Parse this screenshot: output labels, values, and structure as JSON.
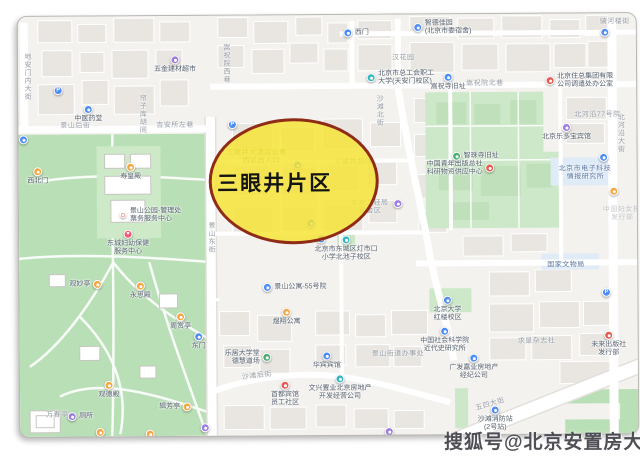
{
  "region_annotation": {
    "label": "三眼井片区",
    "ellipse_fill": "#F6E434",
    "ellipse_border": "#8F2B17"
  },
  "watermark": {
    "text": "搜狐号@北京安置房大全"
  },
  "colors": {
    "map_bg": "#f4f2ef",
    "building": "#e9e6e2",
    "park_green": "#b9dfb6",
    "institution_green": "#cde8c8",
    "poi_box_blue": "#e0ebf8",
    "road": "#ffffff",
    "pin_blue": "#4e8df5",
    "pin_teal": "#35b8c2",
    "pin_purple": "#9d7ce0",
    "pin_orange": "#f5a742",
    "pin_red": "#e8594f",
    "pin_green": "#4caf6e",
    "pin_heart": "#ef5b77"
  },
  "streets": [
    {
      "id": "st-dianmennei",
      "text": "地安门内大街",
      "x": 4,
      "y": 36,
      "vertical": true
    },
    {
      "id": "st-jingshanhou",
      "text": "景山后街",
      "x": 42,
      "y": 104,
      "vertical": false
    },
    {
      "id": "st-jiansuozuo",
      "text": "吉安所左巷",
      "x": 138,
      "y": 104,
      "vertical": false
    },
    {
      "id": "st-lianziku",
      "text": "帘子库胡同",
      "x": 119,
      "y": 78,
      "vertical": true
    },
    {
      "id": "st-songzhuxixiang",
      "text": "嵩祝院西巷",
      "x": 203,
      "y": 28,
      "vertical": true
    },
    {
      "id": "st-shatanbei",
      "text": "沙滩北街",
      "x": 356,
      "y": 80,
      "vertical": true
    },
    {
      "id": "st-songzhubeixiang",
      "text": "嵩祝院北巷",
      "x": 448,
      "y": 64,
      "vertical": false
    },
    {
      "id": "st-beiheyan",
      "text": "北河沿大街",
      "x": 597,
      "y": 100,
      "vertical": true
    },
    {
      "id": "st-jingshandong",
      "text": "景山东街",
      "x": 187,
      "y": 206,
      "vertical": true
    },
    {
      "id": "st-shatanhou",
      "text": "沙滩后街",
      "x": 222,
      "y": 355,
      "vertical": false,
      "angle": -6
    },
    {
      "id": "st-wusidajie",
      "text": "五四大街",
      "x": 455,
      "y": 385,
      "vertical": false,
      "angle": -16
    },
    {
      "id": "st-qihelou",
      "text": "骑河楼街",
      "x": 582,
      "y": 3,
      "vertical": false
    },
    {
      "id": "st-hanhuayuan",
      "text": "汉花园",
      "x": 374,
      "y": 38,
      "vertical": false
    },
    {
      "id": "lbl-sanyanjing-hutong",
      "text": "三眼井胡同",
      "x": 316,
      "y": 142,
      "vertical": false,
      "under": true
    },
    {
      "id": "lbl-beiheyan77",
      "text": "北河沿77号院",
      "x": 556,
      "y": 96,
      "vertical": false
    },
    {
      "id": "lbl-guojiawenwuju",
      "text": "国家文物局",
      "x": 528,
      "y": 246,
      "vertical": false,
      "cls": "blue-label"
    },
    {
      "id": "lbl-dianzikeji",
      "text": "北京市电子科技",
      "x": 540,
      "y": 150,
      "vertical": false,
      "cls": "blue-label"
    },
    {
      "id": "lbl-dianzikeji2",
      "text": "情报研究所",
      "x": 548,
      "y": 158,
      "vertical": false,
      "cls": "blue-label"
    },
    {
      "id": "lbl-qiushi",
      "text": "求是杂志社",
      "x": 498,
      "y": 322,
      "vertical": false
    },
    {
      "id": "lbl-jiedao",
      "text": "景山街道办事处",
      "x": 352,
      "y": 334,
      "vertical": false
    },
    {
      "id": "lbl-funvbao",
      "text": "中国妇女报",
      "x": 584,
      "y": 191,
      "vertical": false,
      "cls": "faint"
    },
    {
      "id": "lbl-funvbao2",
      "text": "发行部",
      "x": 592,
      "y": 199,
      "vertical": false,
      "cls": "faint"
    },
    {
      "id": "lbl-wanchunting",
      "text": "万春亭",
      "x": 26,
      "y": 393,
      "vertical": false
    },
    {
      "id": "lbl-jiudian1",
      "text": "三眼井大酒店公寓",
      "x": 208,
      "y": 132,
      "vertical": false,
      "cls": "green-label",
      "under": true
    },
    {
      "id": "lbl-jiudian2",
      "text": "西区出入口",
      "x": 224,
      "y": 140,
      "vertical": false,
      "cls": "green-label",
      "under": true
    },
    {
      "id": "lbl-erqingju",
      "text": "北京二轻局",
      "x": 332,
      "y": 183,
      "vertical": false,
      "under": true
    },
    {
      "id": "lbl-erqingju2",
      "text": "宿舍区",
      "x": 340,
      "y": 191,
      "vertical": false,
      "under": true
    }
  ],
  "pois": [
    {
      "id": "parking-nw",
      "x": 40,
      "y": 74,
      "color": "pin_blue",
      "glyph": "P"
    },
    {
      "id": "hardware-store",
      "x": 157,
      "y": 44,
      "color": "pin_purple",
      "glyph": "dot",
      "lines": [
        "五金建材超市"
      ],
      "align": "below"
    },
    {
      "id": "tcm-shop",
      "x": 70,
      "y": 93,
      "color": "pin_blue",
      "glyph": "dot",
      "lines": [
        "中医药堂"
      ],
      "align": "below"
    },
    {
      "id": "west-gate-top",
      "x": 330,
      "y": 18,
      "color": "pin_blue",
      "glyph": "dot",
      "lines": [
        "西门"
      ],
      "align": "right"
    },
    {
      "id": "zhide-jiayuan",
      "x": 400,
      "y": 13,
      "color": "pin_blue",
      "glyph": "dot",
      "lines": [
        "智德佳园",
        "(北京市委宿舍)"
      ],
      "align": "right"
    },
    {
      "id": "gonghui-daxue",
      "x": 353,
      "y": 63,
      "color": "pin_teal",
      "glyph": "dot",
      "lines": [
        "北京市总工会职工",
        "大学(天安门校区)"
      ],
      "align": "right"
    },
    {
      "id": "songzhusi",
      "x": 430,
      "y": 63,
      "color": "pin_blue",
      "glyph": "dot",
      "lines": [
        "嵩祝寺旧址"
      ],
      "align": "below"
    },
    {
      "id": "zhuzong-group",
      "x": 532,
      "y": 67,
      "color": "pin_red",
      "glyph": "dot",
      "lines": [
        "北京住总集团有限",
        "公司调遣处办公室"
      ],
      "align": "right"
    },
    {
      "id": "pin-topright",
      "x": 587,
      "y": 19,
      "color": "pin_blue",
      "glyph": "dot"
    },
    {
      "id": "qingnian-press",
      "x": 471,
      "y": 154,
      "color": "pin_red",
      "glyph": "dot",
      "lines": [
        "中国青年出版总社",
        "科研物资供应中心"
      ],
      "align": "left"
    },
    {
      "id": "zhizhusi",
      "x": 438,
      "y": 142,
      "color": "pin_green",
      "glyph": "dot",
      "lines": [
        "智珠寺旧址"
      ],
      "align": "right"
    },
    {
      "id": "hotel-ledobao",
      "x": 548,
      "y": 114,
      "color": "pin_purple",
      "glyph": "dot",
      "lines": [
        "北京乐多宝宾馆"
      ],
      "align": "below"
    },
    {
      "id": "pin-right-1",
      "x": 585,
      "y": 144,
      "color": "pin_blue",
      "glyph": "dot"
    },
    {
      "id": "pin-right-2",
      "x": 595,
      "y": 178,
      "color": "pin_orange",
      "glyph": "dot"
    },
    {
      "id": "parking-right",
      "x": 587,
      "y": 279,
      "color": "pin_blue",
      "glyph": "P"
    },
    {
      "id": "weilai-press",
      "x": 589,
      "y": 322,
      "color": "pin_red",
      "glyph": "dot",
      "lines": [
        "未来出版社",
        "发行部"
      ],
      "align": "below"
    },
    {
      "id": "xiaofangzhan",
      "x": 475,
      "y": 396,
      "color": "pin_blue",
      "glyph": "dot",
      "lines": [
        "沙滩消防站",
        "(2号站)"
      ],
      "align": "below"
    },
    {
      "id": "beida-honglou",
      "x": 428,
      "y": 286,
      "color": "pin_blue",
      "glyph": "dot",
      "lines": [
        "北京大学",
        "红楼校区"
      ],
      "align": "below"
    },
    {
      "id": "shekeyuan",
      "x": 425,
      "y": 317,
      "color": "pin_blue",
      "glyph": "dot",
      "lines": [
        "中国社会科学院",
        "近代史研究所"
      ],
      "align": "below"
    },
    {
      "id": "huabin-hotel",
      "x": 307,
      "y": 341,
      "color": "pin_blue",
      "glyph": "dot",
      "lines": [
        "华宾宾馆"
      ],
      "align": "below"
    },
    {
      "id": "wenxing-zhiye",
      "x": 320,
      "y": 364,
      "color": "pin_teal",
      "glyph": "dot",
      "lines": [
        "文兴置业北京房地产",
        "开发经营公司"
      ],
      "align": "below"
    },
    {
      "id": "shoudu-shequ",
      "x": 265,
      "y": 370,
      "color": "pin_red",
      "glyph": "dot",
      "lines": [
        "首都宾馆",
        "员工社区"
      ],
      "align": "below"
    },
    {
      "id": "guangfa-jiaye",
      "x": 454,
      "y": 344,
      "color": "pin_blue",
      "glyph": "dot",
      "lines": [
        "广发嘉业房地产",
        "经纪公司"
      ],
      "align": "below"
    },
    {
      "id": "pin-bottom-1",
      "x": 369,
      "y": 417,
      "color": "pin_purple",
      "glyph": "dot"
    },
    {
      "id": "gongyu-55",
      "x": 248,
      "y": 272,
      "color": "pin_blue",
      "glyph": "dot",
      "lines": [
        "景山公寓-55号院"
      ],
      "align": "right"
    },
    {
      "id": "yuxiang-gongyu",
      "x": 267,
      "y": 297,
      "color": "pin_orange",
      "glyph": "dot",
      "lines": [
        "煜翔公寓"
      ],
      "align": "below"
    },
    {
      "id": "leju-daxuetang",
      "x": 247,
      "y": 342,
      "color": "pin_green",
      "glyph": "dot",
      "lines": [
        "乐居大学堂",
        "德慧道场"
      ],
      "align": "left"
    },
    {
      "id": "pin-bottom-2",
      "x": 185,
      "y": 412,
      "color": "pin_purple",
      "glyph": "dot"
    },
    {
      "id": "east-gate",
      "x": 179,
      "y": 321,
      "color": "pin_blue",
      "glyph": "dot",
      "lines": [
        "东门"
      ],
      "align": "below"
    },
    {
      "id": "guanmiaoting",
      "x": 78,
      "y": 268,
      "color": "pin_orange",
      "glyph": "dot",
      "lines": [
        "观妙亭"
      ],
      "align": "left"
    },
    {
      "id": "yongsidian",
      "x": 121,
      "y": 270,
      "color": "pin_orange",
      "glyph": "dot",
      "lines": [
        "永思殿"
      ],
      "align": "below"
    },
    {
      "id": "zhoushangting",
      "x": 161,
      "y": 301,
      "color": "pin_orange",
      "glyph": "dot",
      "lines": [
        "周赏亭"
      ],
      "align": "below"
    },
    {
      "id": "guandedian",
      "x": 89,
      "y": 369,
      "color": "pin_orange",
      "glyph": "dot",
      "lines": [
        "观德殿"
      ],
      "align": "below"
    },
    {
      "id": "jifangting",
      "x": 167,
      "y": 391,
      "color": "pin_orange",
      "glyph": "dot",
      "lines": [
        "辑芳亭"
      ],
      "align": "left"
    },
    {
      "id": "cesuo",
      "x": 52,
      "y": 400,
      "color": "pin_purple",
      "glyph": "dot",
      "lines": [
        "厕所"
      ],
      "align": "right"
    },
    {
      "id": "pin-park-1",
      "x": 80,
      "y": 416,
      "color": "pin_orange",
      "glyph": "dot"
    },
    {
      "id": "pin-park-2",
      "x": 130,
      "y": 418,
      "color": "pin_orange",
      "glyph": "dot"
    },
    {
      "id": "xibeimen",
      "x": 19,
      "y": 155,
      "color": "pin_orange",
      "glyph": "dot",
      "lines": [
        "西北门"
      ],
      "align": "below"
    },
    {
      "id": "shouhuangdian",
      "x": 112,
      "y": 151,
      "color": "pin_orange",
      "glyph": "dot",
      "lines": [
        "寿皇殿"
      ],
      "align": "below"
    },
    {
      "id": "pin-west-gate",
      "x": 5,
      "y": 123,
      "color": "pin_blue",
      "glyph": "dot"
    },
    {
      "id": "park-office",
      "x": 104,
      "y": 199,
      "color": "pin_red",
      "glyph": "dot",
      "small": true,
      "lines": [
        "景山公园-管理处",
        "票务服务中心"
      ],
      "align": "right"
    },
    {
      "id": "fuyou-baojian",
      "x": 109,
      "y": 218,
      "color": "pin_heart",
      "glyph": "heart",
      "lines": [
        "东城妇幼保健",
        "服务中心"
      ],
      "align": "below"
    },
    {
      "id": "dengshikou-xiaoxue",
      "x": 327,
      "y": 225,
      "color": "pin_teal",
      "glyph": "dot",
      "lines": [
        "北京市东城区灯市口",
        "小学北池子校区"
      ],
      "align": "below"
    },
    {
      "id": "pin-oval-1",
      "x": 279,
      "y": 150,
      "color": "pin_blue",
      "glyph": "dot",
      "under": true
    },
    {
      "id": "pin-oval-2",
      "x": 292,
      "y": 208,
      "color": "pin_blue",
      "glyph": "dot",
      "under": true
    },
    {
      "id": "pin-oval-3",
      "x": 302,
      "y": 224,
      "color": "pin_blue",
      "glyph": "dot",
      "under": true
    },
    {
      "id": "parking-oval",
      "x": 214,
      "y": 109,
      "color": "pin_blue",
      "glyph": "P"
    },
    {
      "id": "pin-mid-purple",
      "x": 379,
      "y": 189,
      "color": "pin_purple",
      "glyph": "dot"
    }
  ]
}
